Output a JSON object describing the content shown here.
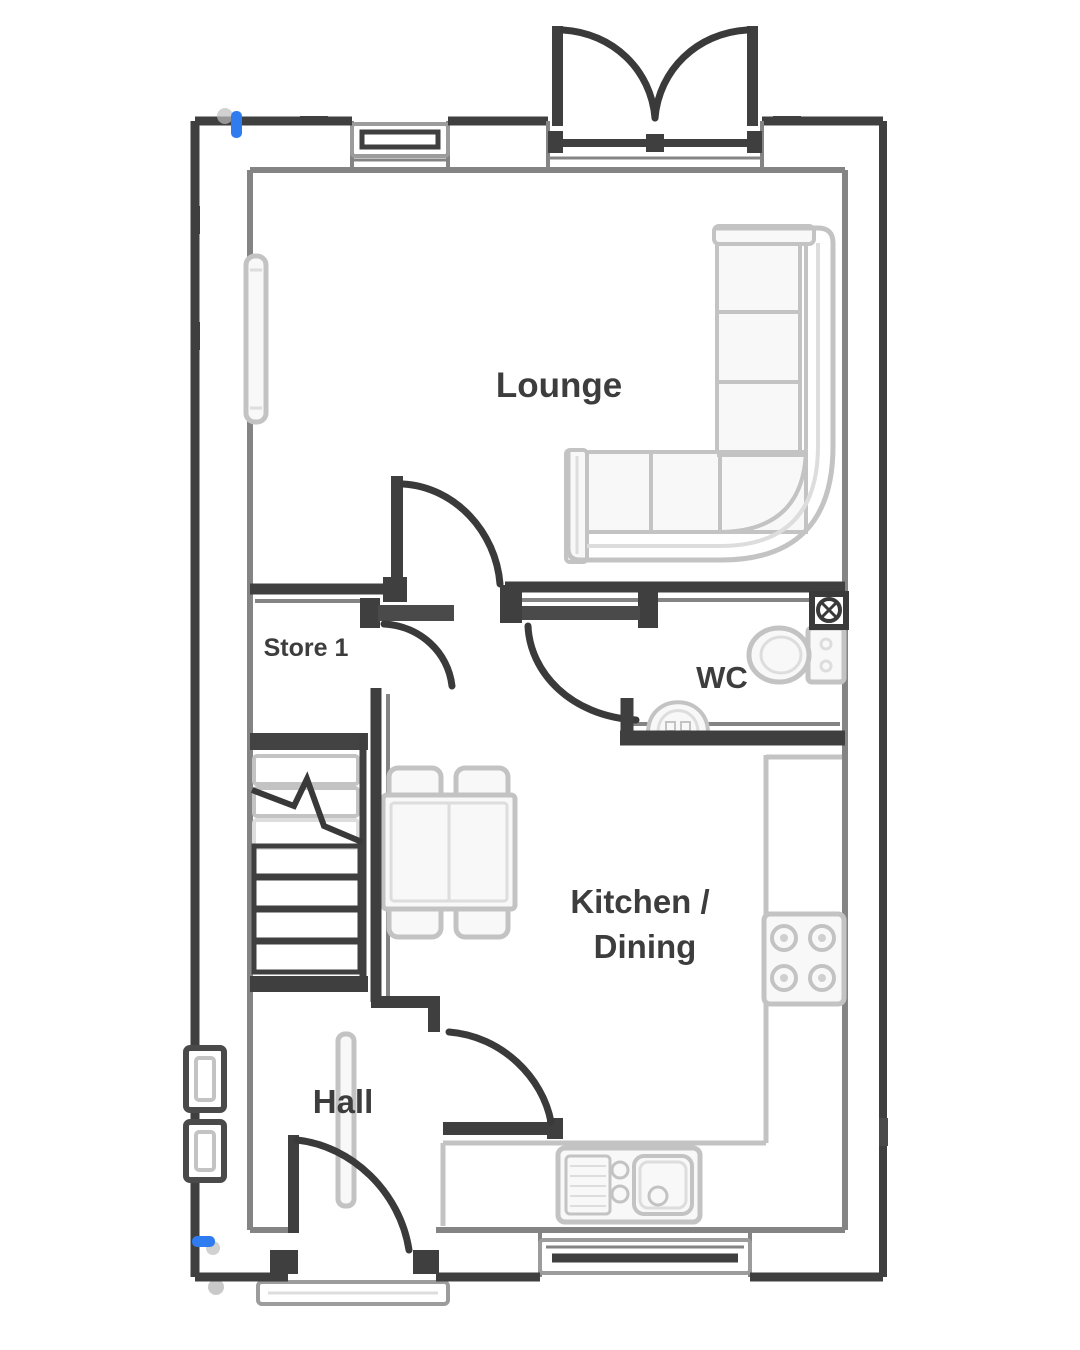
{
  "document": {
    "type": "floor-plan",
    "background": "#ffffff"
  },
  "colors": {
    "wall": "#3f3f3f",
    "wall_inner_face": "#7a7a7a",
    "fixture_gray": "#c3c3c3",
    "text": "#3d3d3d",
    "marker_blue": "#2f7bf0"
  },
  "rooms": {
    "lounge": {
      "label": "Lounge"
    },
    "store": {
      "label": "Store 1"
    },
    "wc": {
      "label": "WC"
    },
    "kitchen_dining": {
      "label_line1": "Kitchen /",
      "label_line2": "Dining"
    },
    "hall": {
      "label": "Hall"
    }
  },
  "fixtures": [
    "french-doors",
    "top-window",
    "corner-sofa",
    "lounge-radiator",
    "store-door",
    "lounge-door",
    "wc-door",
    "extractor-fan",
    "toilet",
    "corner-basin",
    "staircase",
    "dining-table",
    "dining-chairs",
    "hall-radiator",
    "kitchen-door",
    "worktop",
    "hob",
    "sink-drainer",
    "kitchen-window",
    "front-door",
    "door-threshold",
    "meter-boxes",
    "utility-markers"
  ]
}
